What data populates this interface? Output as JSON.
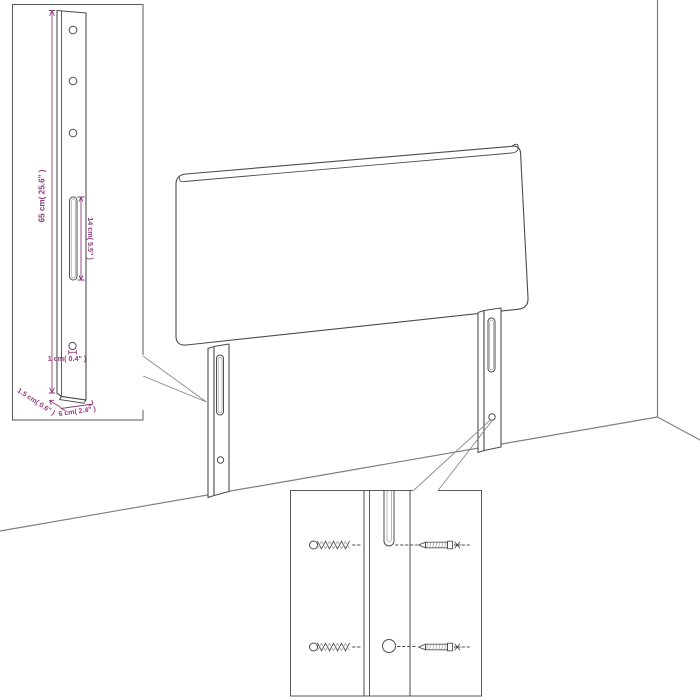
{
  "colors": {
    "background": "#ffffff",
    "line": "#4d4d4d",
    "wall": "#7f7f7f",
    "dimension": "#8e3d7b"
  },
  "diagram": {
    "type": "furniture-assembly-diagram",
    "subject": "upholstered headboard with two mounting legs shown against a room corner, with two magnified detail insets",
    "insets": {
      "leg_detail": {
        "description": "magnified mounting leg with three drill holes, long slot and small screw hole",
        "labels": {
          "height": "65 cm( 25.6\" )",
          "slot_length": "14 cm( 5.5\" )",
          "hole_diameter": "1 cm( 0.4\" )",
          "side_depth": "1.5 cm( 0.6\" )",
          "leg_width": "6 cm( 2.4\" )"
        }
      },
      "fastener_detail": {
        "description": "magnified leg slot and hole with threaded inserts on the left and screws on the right"
      }
    }
  }
}
